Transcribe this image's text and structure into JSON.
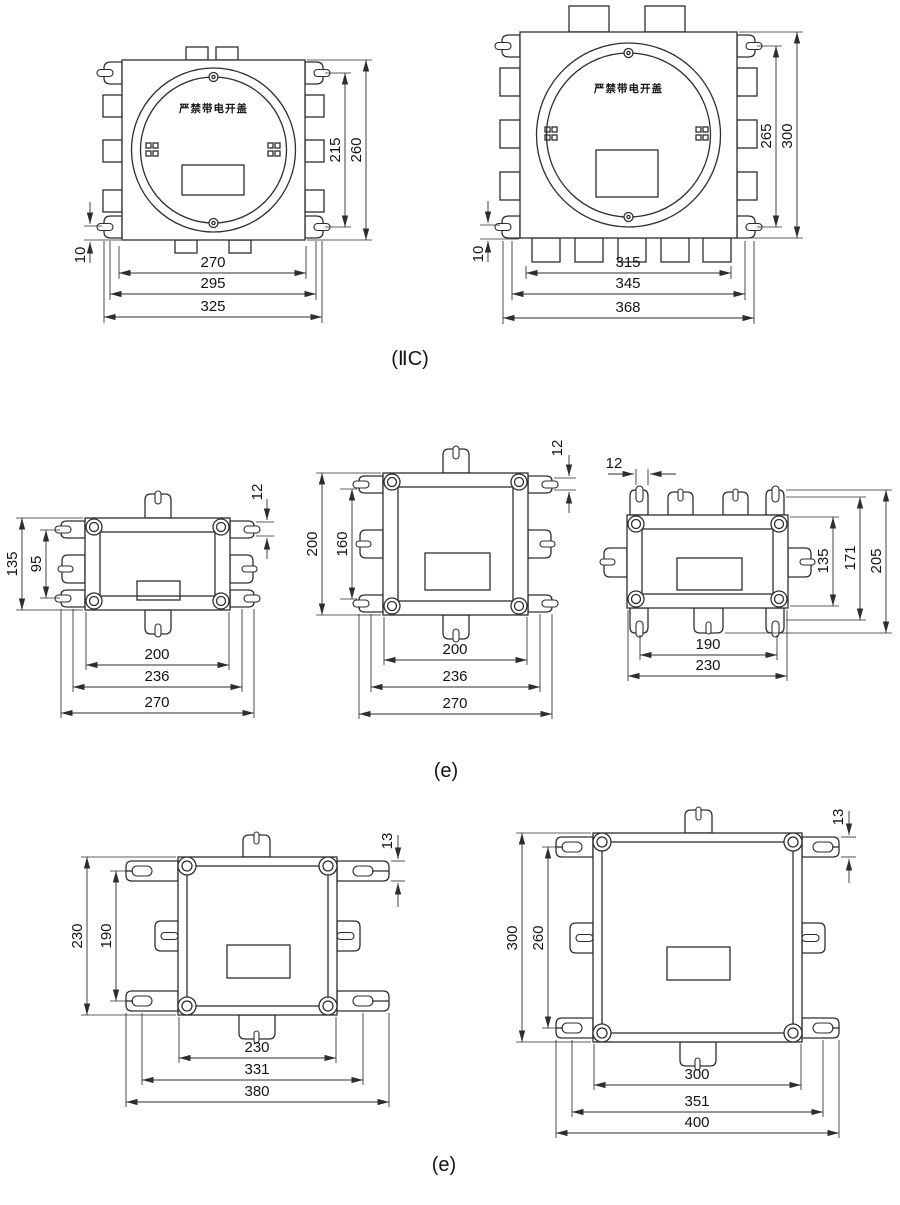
{
  "figures": {
    "iic": {
      "caption": "(ⅡC)",
      "small_box": {
        "warning": "严禁带电开盖",
        "height_inner": "215",
        "height_outer": "260",
        "width_inner": "270",
        "width_mid": "295",
        "width_outer": "325",
        "foot_offset": "10"
      },
      "large_box": {
        "warning": "严禁带电开盖",
        "height_inner": "265",
        "height_outer": "300",
        "width_inner": "315",
        "width_mid": "345",
        "width_outer": "368",
        "foot_offset": "10"
      }
    },
    "e_mid": {
      "caption": "(e)",
      "small_box": {
        "height_outer": "135",
        "height_inner": "95",
        "ear_offset": "12",
        "width_inner": "200",
        "width_mid": "236",
        "width_outer": "270"
      },
      "square_box": {
        "height_outer": "200",
        "height_inner": "160",
        "ear_offset": "12",
        "width_inner": "200",
        "width_mid": "236",
        "width_outer": "270"
      },
      "wide_box": {
        "slot_width": "12",
        "height_inner": "135",
        "height_mid": "171",
        "height_outer": "205",
        "width_inner": "190",
        "width_outer": "230"
      }
    },
    "e_bottom": {
      "caption": "(e)",
      "medium_box": {
        "height_outer": "230",
        "height_inner": "190",
        "ear_offset": "13",
        "width_inner": "230",
        "width_mid": "331",
        "width_outer": "380"
      },
      "large_box": {
        "height_outer": "300",
        "height_inner": "260",
        "ear_offset": "13",
        "width_inner": "300",
        "width_mid": "351",
        "width_outer": "400"
      }
    }
  }
}
